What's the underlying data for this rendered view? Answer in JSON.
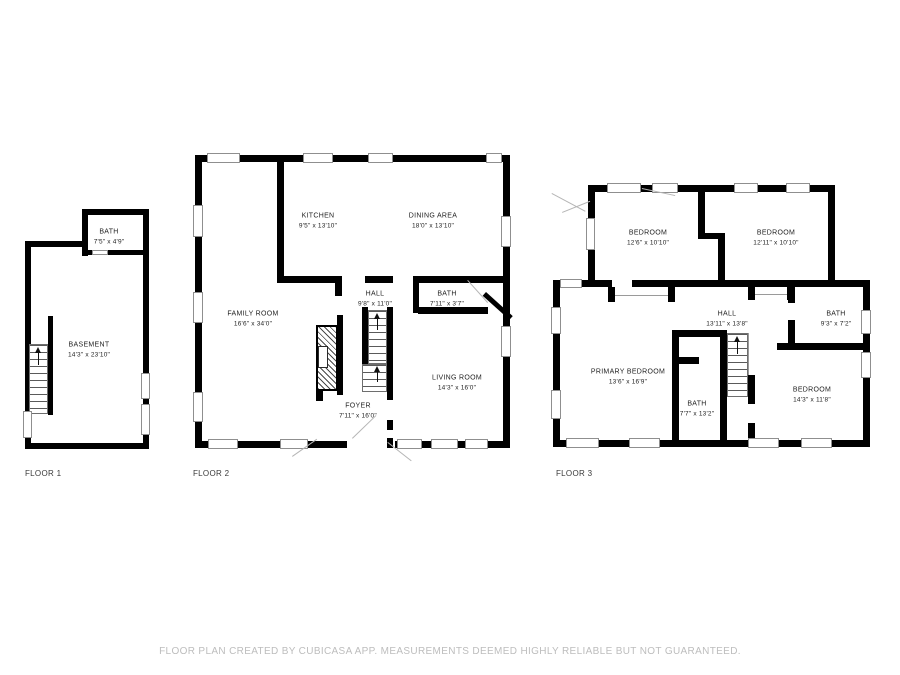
{
  "footer": "FLOOR PLAN CREATED BY CUBICASA APP. MEASUREMENTS DEEMED HIGHLY RELIABLE BUT NOT GUARANTEED.",
  "colors": {
    "wall": "#000000",
    "window_frame": "#8f8f8f",
    "room_label": "#1f1f1f",
    "floor_label": "#3a3a3a",
    "footer_text": "#bdbdbd",
    "background": "#ffffff"
  },
  "floors": [
    {
      "label": "FLOOR 1",
      "rooms": [
        {
          "name": "BATH",
          "dims": "7'5\" x 4'9\""
        },
        {
          "name": "BASEMENT",
          "dims": "14'3\" x 23'10\""
        }
      ]
    },
    {
      "label": "FLOOR 2",
      "rooms": [
        {
          "name": "KITCHEN",
          "dims": "9'5\" x 13'10\""
        },
        {
          "name": "DINING AREA",
          "dims": "18'0\" x 13'10\""
        },
        {
          "name": "FAMILY ROOM",
          "dims": "16'6\" x 34'0\""
        },
        {
          "name": "HALL",
          "dims": "9'8\" x 11'0\""
        },
        {
          "name": "BATH",
          "dims": "7'11\" x 3'7\""
        },
        {
          "name": "LIVING ROOM",
          "dims": "14'3\" x 16'0\""
        },
        {
          "name": "FOYER",
          "dims": "7'11\" x 16'0\""
        }
      ]
    },
    {
      "label": "FLOOR 3",
      "rooms": [
        {
          "name": "BEDROOM",
          "dims": "12'6\" x 10'10\""
        },
        {
          "name": "BEDROOM",
          "dims": "12'11\" x 10'10\""
        },
        {
          "name": "HALL",
          "dims": "13'11\" x 13'8\""
        },
        {
          "name": "BATH",
          "dims": "9'3\" x 7'2\""
        },
        {
          "name": "PRIMARY BEDROOM",
          "dims": "13'6\" x 16'9\""
        },
        {
          "name": "BATH",
          "dims": "7'7\" x 13'2\""
        },
        {
          "name": "BEDROOM",
          "dims": "14'3\" x 11'8\""
        }
      ]
    }
  ]
}
